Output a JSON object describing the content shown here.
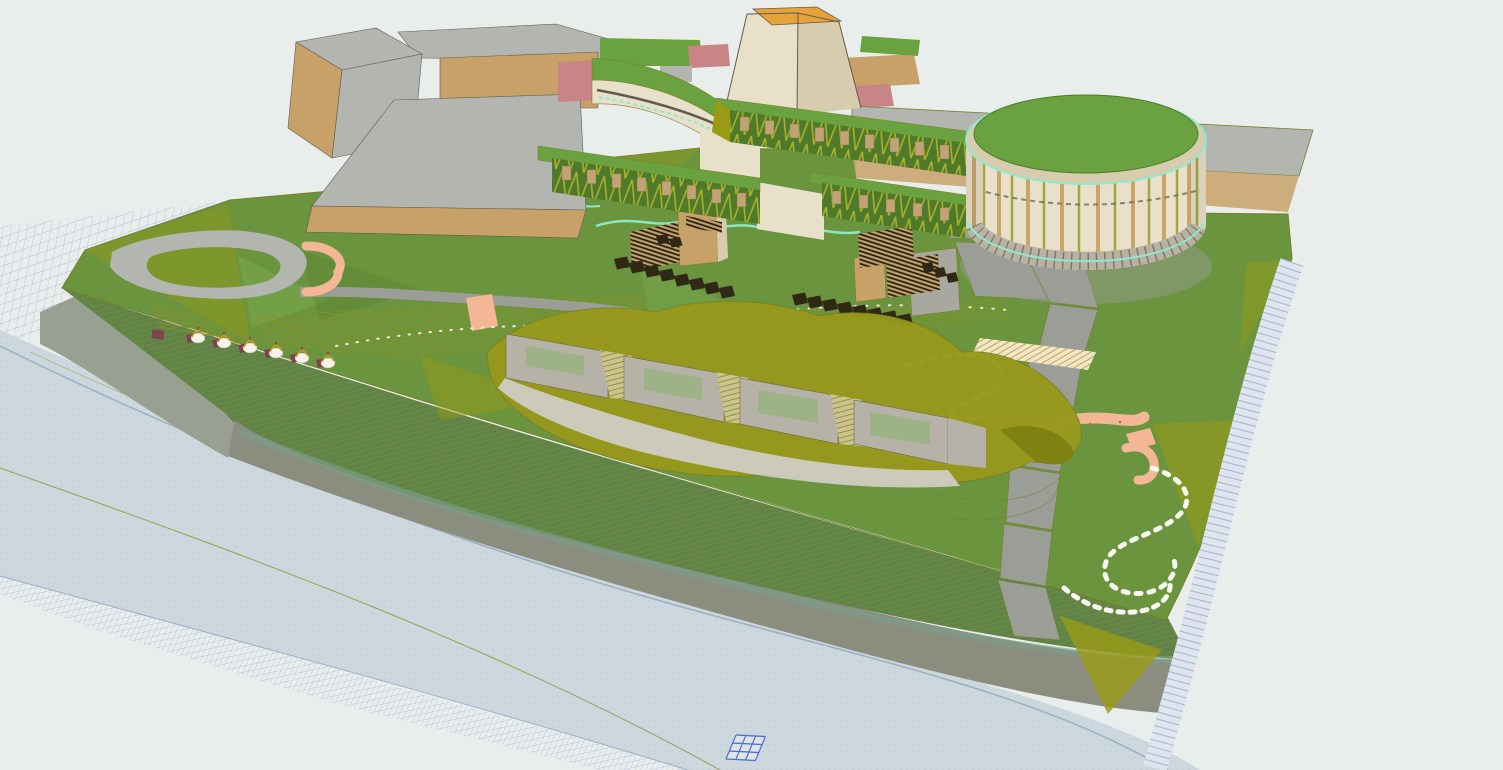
{
  "viewport": {
    "type": "3d-model-viewport",
    "width": 1503,
    "height": 770,
    "view": "aerial axonometric massing model of a riverfront landscape-architecture site",
    "background": "#e9edec"
  },
  "palette": {
    "bg": "#e9edec",
    "water": "#ccd7de",
    "wateredge": "#8fa6bd",
    "gridline": "#a9bedd",
    "band": "#dfe5ee",
    "bandline": "#9fadc9",
    "road": "#8b8d7f",
    "embank": "#99a092",
    "slope": "#5f844a",
    "slopeteal": "#7ba08c",
    "grass": "#6a943e",
    "grasslight": "#7cab4d",
    "olive": "#8b921f",
    "facet": "#9a9b14",
    "tan": "#c8a169",
    "cream": "#e9e0ca",
    "cream2": "#d8ccae",
    "orange": "#e8a23a",
    "rose": "#c98585",
    "salmon": "#f4b795",
    "maroon": "#7e434c",
    "plaza": "#b3b5b1",
    "graypath": "#9b9d97",
    "stone": "#a8a8a0",
    "darkstep": "#2e2815",
    "window": "#c2a276",
    "wallgreen": "#4e7a2a",
    "brace": "#b9ba2e",
    "roofgreen": "#6aa23f",
    "canopy": "#97991c",
    "wallgray": "#b7b2a8",
    "apron": "#cfccc3",
    "glass": "#9db387",
    "cyan": "#8fe9cc",
    "white": "#f7f6f1",
    "marker": "#4f6fcc",
    "outline": "#787f28",
    "darkline": "#5f5c4e",
    "cylstripe1": "#c9a668",
    "cylstripe2": "#a8a43e"
  },
  "scene": {
    "groups": [
      {
        "name": "terrain-grid-plane",
        "description": "blue wireframe terrain mesh extending past site edges",
        "color": "gridline"
      },
      {
        "name": "river",
        "description": "textured river water surface along lower left",
        "color": "water"
      },
      {
        "name": "embankment",
        "description": "gray retaining embankment wall at west bank",
        "color": "embank"
      },
      {
        "name": "riverside-road",
        "description": "gray riverside road band",
        "color": "road"
      },
      {
        "name": "riverbank-slope",
        "description": "striped planted slope between park and road",
        "color": "slope"
      },
      {
        "name": "park-lawn",
        "description": "triangulated green park terrain with olive facets",
        "color": "grass"
      },
      {
        "name": "loop-road",
        "description": "vehicular loop road at west entry",
        "color": "plaza"
      },
      {
        "name": "crescent-plaza",
        "description": "salmon crescent entry plaza",
        "color": "salmon"
      },
      {
        "name": "gray-path-chain",
        "description": "angular stone path segments descending the park",
        "color": "graypath"
      },
      {
        "name": "boardwalk-arcs",
        "description": "hatched curved boardwalk decks",
        "color": "window"
      },
      {
        "name": "stepping-stones",
        "description": "white stepping-stone S-curves",
        "color": "white"
      },
      {
        "name": "salmon-ramps",
        "description": "accessible salmon ramps and landings",
        "color": "salmon"
      },
      {
        "name": "stream",
        "description": "meandering cyan stream lines",
        "color": "cyan"
      },
      {
        "name": "terrace-stairs",
        "description": "dark planter steps with tan retaining blocks",
        "color": "darkstep"
      },
      {
        "name": "pavilion-row",
        "description": "row of small white vaulted pavilions with maroon bases",
        "color": "maroon"
      },
      {
        "name": "campus-buildings",
        "description": "existing gray/tan building massing with rose roofs, northwest",
        "color": "tan"
      },
      {
        "name": "ribbon-building",
        "description": "curved cream building with green roof and stream line",
        "color": "cream"
      },
      {
        "name": "gateway-tower",
        "description": "tapered tower with orange top",
        "color": "orange"
      },
      {
        "name": "terraced-green-walls",
        "description": "stepped green facade walls with tan windows and bracing",
        "color": "wallgreen"
      },
      {
        "name": "earth-sheltered-gallery",
        "description": "olive canopy building with gray walls and glazed bays",
        "color": "canopy"
      },
      {
        "name": "cylindrical-pavilion",
        "description": "round timber-slat pavilion with green roof and cyan rims",
        "color": "cream2"
      },
      {
        "name": "edge-steps-band",
        "description": "stepped light-blue revetment band on east boundary",
        "color": "band"
      },
      {
        "name": "survey-grid-marker",
        "description": "small blue 3x3 grid marker on water",
        "color": "marker"
      }
    ]
  }
}
